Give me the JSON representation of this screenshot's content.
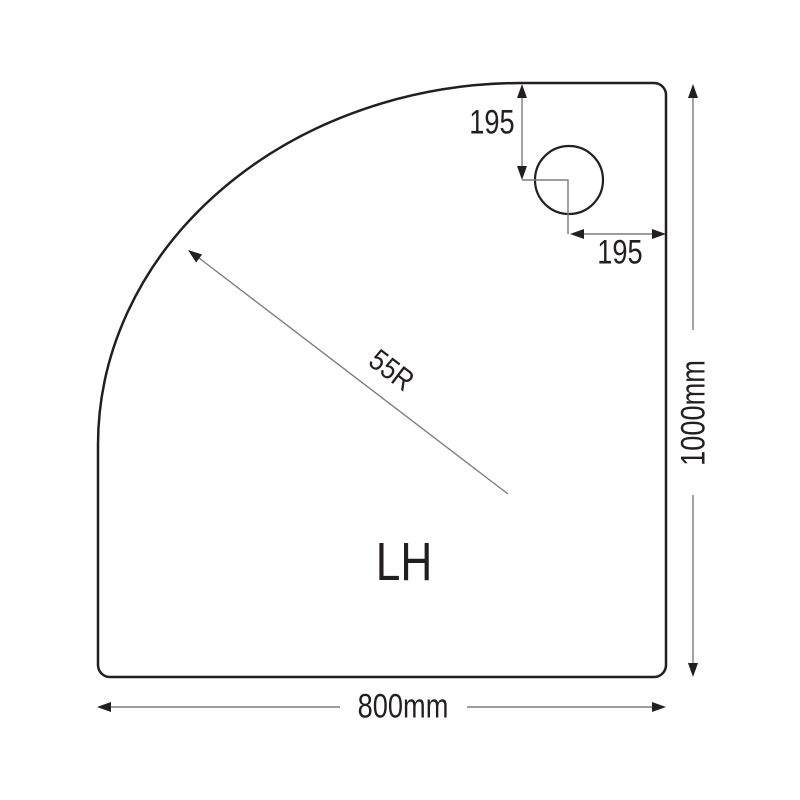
{
  "drawing": {
    "description": "offset-quadrant-shower-tray-technical-drawing",
    "tray_label": "LH",
    "bottom_dimension": "800mm",
    "right_dimension": "1000mm",
    "radius_label": "55R",
    "waste_vertical_offset": "195",
    "waste_horizontal_offset": "195"
  },
  "colors": {
    "background": "#ffffff",
    "outline": "#231f20",
    "dimension": "#7d7d7d",
    "text": "#231f20"
  }
}
